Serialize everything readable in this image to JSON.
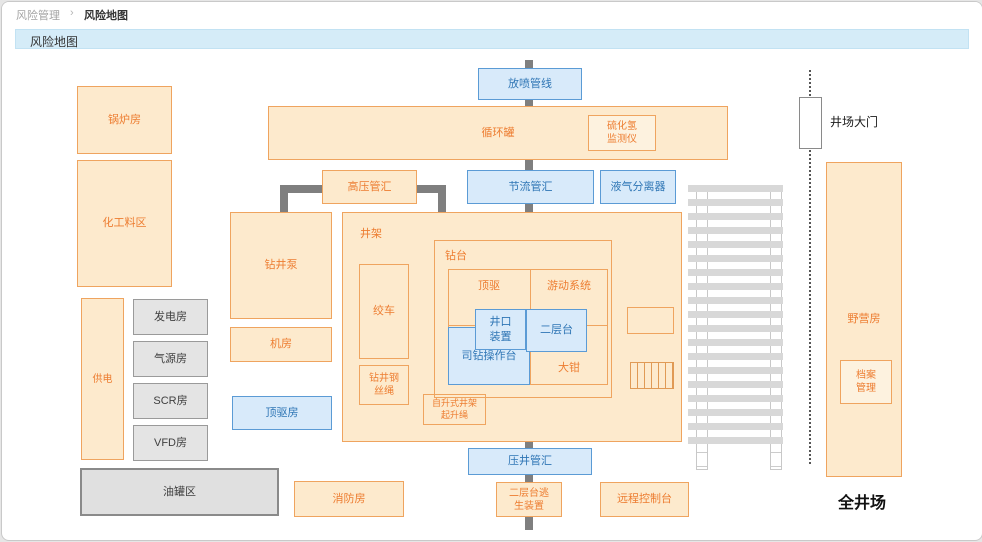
{
  "breadcrumb": {
    "section": "风险管理",
    "separator": "›",
    "page": "风险地图"
  },
  "titlebar": {
    "title": "风险地图"
  },
  "diagram": {
    "blowout_line": "放喷管线",
    "circulation_tank": "循环罐",
    "h2s_monitor": "硫化氢监测仪",
    "hp_manifold": "高压管汇",
    "choke_manifold": "节流管汇",
    "gas_liquid_separator": "液气分离器",
    "boiler_room": "锅炉房",
    "chemical_area": "化工料区",
    "power_supply": "供电",
    "generator_room": "发电房",
    "air_source_room": "气源房",
    "scr_room": "SCR房",
    "vfd_room": "VFD房",
    "oil_tank_area": "油罐区",
    "drilling_pump": "钻井泵",
    "machine_room": "机房",
    "top_drive_room": "顶驱房",
    "derrick": "井架",
    "drawworks": "绞车",
    "drilling_wire_rope": "钻井钢丝绳",
    "drill_floor": "钻台",
    "top_drive": "顶驱",
    "traveling_system": "游动系统",
    "wellhead_assembly": "井口装置",
    "monkey_board": "二层台",
    "driller_console": "司钻操作台",
    "tongs": "大钳",
    "derrick_hoist_rope": "自升式井架起升绳",
    "kill_manifold": "压井管汇",
    "escape_device": "二层台逃生装置",
    "remote_console": "远程控制台",
    "fire_room": "消防房",
    "site_gate": "井场大门",
    "camp_house": "野营房",
    "archive_mgmt": "档案管理",
    "site_label": "全井场"
  },
  "colors": {
    "orange_fill": "#fdeacd",
    "orange_border": "#efa45f",
    "orange_text": "#ed7d31",
    "blue_fill": "#d8eafa",
    "blue_border": "#5b9bd5",
    "blue_text": "#2f76b5",
    "gray_fill": "#e4e4e4",
    "gray_border": "#9a9a9a",
    "gray_text": "#3f3f3f",
    "pipe_gray": "#7f7f7f",
    "rack_gray": "#d8d8d8",
    "titlebar_blue": "#d5ecf8"
  }
}
